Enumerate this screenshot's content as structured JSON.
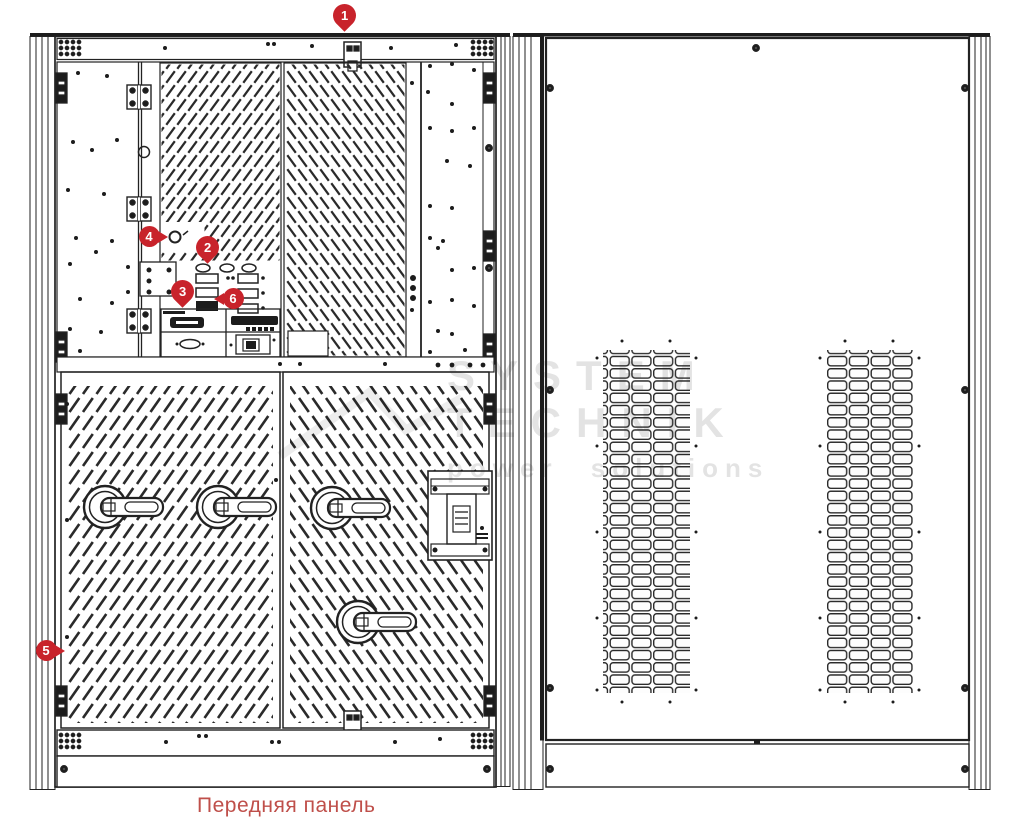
{
  "caption": "Передняя панель",
  "watermark": {
    "line1": "SYSTEM",
    "line2": "TECHNIK",
    "line3": "power solutions"
  },
  "markers": [
    {
      "label": "1",
      "type": "pin",
      "x": 344,
      "y": 15
    },
    {
      "label": "2",
      "type": "pin",
      "x": 207,
      "y": 247
    },
    {
      "label": "3",
      "type": "pin",
      "x": 182,
      "y": 291
    },
    {
      "label": "4",
      "type": "arrow-right",
      "x": 149,
      "y": 236
    },
    {
      "label": "5",
      "type": "arrow-right",
      "x": 46,
      "y": 650
    },
    {
      "label": "6",
      "type": "arrow-left",
      "x": 233,
      "y": 298
    }
  ],
  "colors": {
    "marker_red": "#c8232b",
    "caption_red": "#bf4f4a",
    "line_ink": "#222222",
    "watermark_gray": "#d9d9d9"
  }
}
